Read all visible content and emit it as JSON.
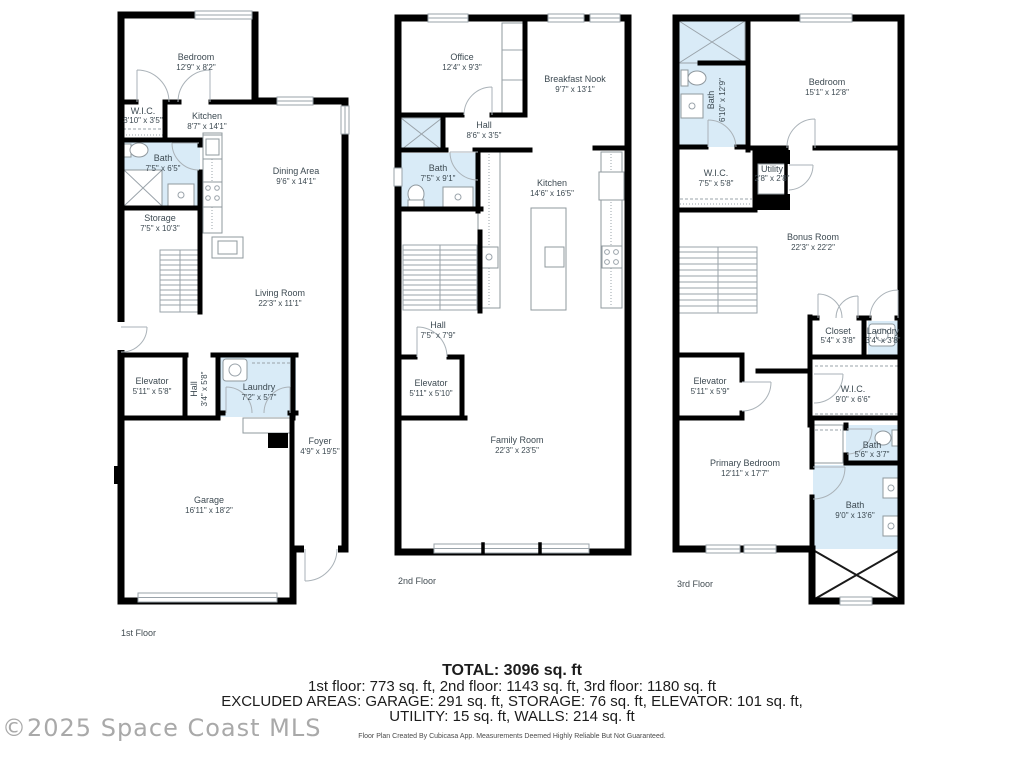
{
  "watermark": "©2025 Space Coast MLS",
  "summary": {
    "total": "TOTAL: 3096 sq. ft",
    "line2": "1st floor: 773 sq. ft, 2nd floor: 1143 sq. ft, 3rd floor: 1180 sq. ft",
    "line3": "EXCLUDED AREAS: GARAGE: 291 sq. ft, STORAGE: 76 sq. ft, ELEVATOR: 101 sq. ft,",
    "line4": "UTILITY: 15 sq. ft, WALLS: 214 sq. ft",
    "disclaimer": "Floor Plan Created By Cubicasa App. Measurements Deemed Highly Reliable But Not Guaranteed."
  },
  "colors": {
    "wall": "#000000",
    "wet_room": "#d9ebf7",
    "label_text": "#3d4a52"
  },
  "floor1": {
    "label": "1st Floor",
    "rooms": {
      "bedroom": {
        "name": "Bedroom",
        "dims": "12'9\" x 8'2\""
      },
      "wic": {
        "name": "W.I.C.",
        "dims": "3'10\" x 3'5\""
      },
      "kitchen": {
        "name": "Kitchen",
        "dims": "8'7\" x 14'1\""
      },
      "bath": {
        "name": "Bath",
        "dims": "7'5\" x 6'5\""
      },
      "dining": {
        "name": "Dining Area",
        "dims": "9'6\" x 14'1\""
      },
      "storage": {
        "name": "Storage",
        "dims": "7'5\" x 10'3\""
      },
      "living": {
        "name": "Living Room",
        "dims": "22'3\" x 11'1\""
      },
      "elevator": {
        "name": "Elevator",
        "dims": "5'11\" x 5'8\""
      },
      "hall": {
        "name": "Hall",
        "dims": "3'4\" x 5'8\""
      },
      "laundry": {
        "name": "Laundry",
        "dims": "7'2\" x 5'7\""
      },
      "foyer": {
        "name": "Foyer",
        "dims": "4'9\" x 19'5\""
      },
      "garage": {
        "name": "Garage",
        "dims": "16'11\" x 18'2\""
      }
    }
  },
  "floor2": {
    "label": "2nd Floor",
    "rooms": {
      "office": {
        "name": "Office",
        "dims": "12'4\" x 9'3\""
      },
      "nook": {
        "name": "Breakfast Nook",
        "dims": "9'7\" x 13'1\""
      },
      "hall": {
        "name": "Hall",
        "dims": "8'6\" x 3'5\""
      },
      "bath": {
        "name": "Bath",
        "dims": "7'5\" x 9'1\""
      },
      "kitchen": {
        "name": "Kitchen",
        "dims": "14'6\" x 16'5\""
      },
      "hall2": {
        "name": "Hall",
        "dims": "7'5\" x 7'9\""
      },
      "elevator": {
        "name": "Elevator",
        "dims": "5'11\" x 5'10\""
      },
      "family": {
        "name": "Family Room",
        "dims": "22'3\" x 23'5\""
      }
    }
  },
  "floor3": {
    "label": "3rd Floor",
    "rooms": {
      "bath1": {
        "name": "Bath",
        "dims": "6'10\" x 12'9\""
      },
      "bedroom": {
        "name": "Bedroom",
        "dims": "15'1\" x 12'8\""
      },
      "wic1": {
        "name": "W.I.C.",
        "dims": "7'5\" x 5'8\""
      },
      "utility": {
        "name": "Utility",
        "dims": "2'8\" x 2'8\""
      },
      "bonus": {
        "name": "Bonus Room",
        "dims": "22'3\" x 22'2\""
      },
      "closet": {
        "name": "Closet",
        "dims": "5'4\" x 3'8\""
      },
      "laundry": {
        "name": "Laundry",
        "dims": "3'4\" x 3'8\""
      },
      "elevator": {
        "name": "Elevator",
        "dims": "5'11\" x 5'9\""
      },
      "wic2": {
        "name": "W.I.C.",
        "dims": "9'0\" x 6'6\""
      },
      "bath2": {
        "name": "Bath",
        "dims": "5'6\" x 3'7\""
      },
      "bath3": {
        "name": "Bath",
        "dims": "9'0\" x 13'6\""
      },
      "primary": {
        "name": "Primary Bedroom",
        "dims": "12'11\" x 17'7\""
      }
    }
  }
}
